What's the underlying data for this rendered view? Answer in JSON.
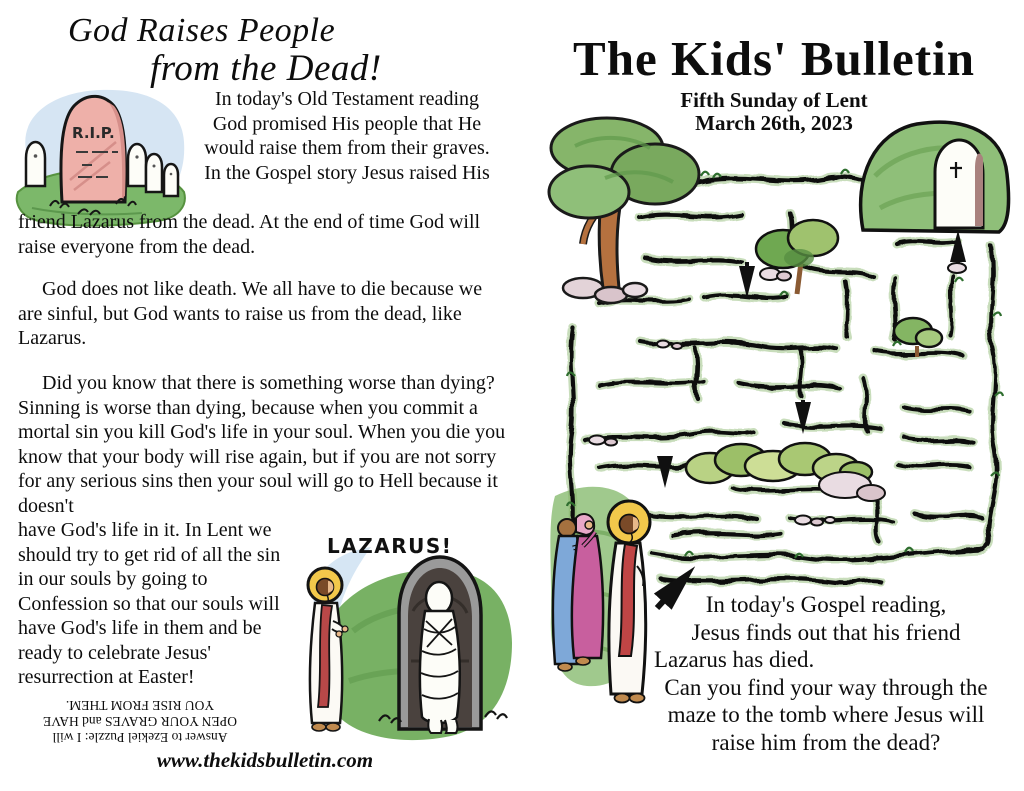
{
  "colors": {
    "paper": "#ffffff",
    "ink": "#0d0d0d",
    "halo_yellow": "#f2c84b",
    "robe_red": "#c04545",
    "grass_green": "#7cb86a",
    "hedge_green": "#8fbf79",
    "stone_pink": "#eeb0a9",
    "sky_blue": "#d6e5f3",
    "dress_blue": "#7ea8d8",
    "dress_magenta": "#c85f9e",
    "tomb_gray": "#8f8f8f"
  },
  "left_page": {
    "title_line1": "God Raises People",
    "title_line2": "from the Dead!",
    "tombstone_label": "R.I.P.",
    "intro_beside_image": "In today's Old Testament reading God promised His people that He would raise them from their graves.  In the Gospel story Jesus raised His",
    "intro_below_image": "friend Lazarus from the dead.  At the end of time God will raise everyone from the dead.",
    "paragraph2": "God does not like death.  We all have to die because we are sinful, but God wants to raise us from the dead, like Lazarus.",
    "paragraph3_wide": "Did you know that there is something worse than dying? Sinning is worse than dying, because when you commit a mortal sin you kill God's life in your soul.  When you die you know that your body will rise again, but if you are not sorry for any serious sins then your soul will go to Hell because it doesn't",
    "paragraph3_narrow": "have God's life in it.  In Lent we should try to get rid of all the sin in our souls by going to Confession so that our souls will have God's life in them and be ready to celebrate Jesus' resurrection at Easter!",
    "lazarus_label": "LAZARUS!",
    "puzzle_answer_lines": [
      "Answer to Ezekiel Puzzle: I will",
      "OPEN YOUR GRAVES and HAVE",
      "YOU RISE FROM THEM."
    ],
    "website": "www.thekidsbulletin.com"
  },
  "right_page": {
    "title": "The Kids' Bulletin",
    "subtitle": "Fifth Sunday of Lent",
    "date": "March 26th, 2023",
    "caption_lines": [
      "In today's Gospel reading,",
      "Jesus finds out that his friend",
      "Lazarus has died.",
      "Can you find your way through the",
      "maze to the tomb where Jesus will",
      "raise him from the dead?"
    ]
  }
}
